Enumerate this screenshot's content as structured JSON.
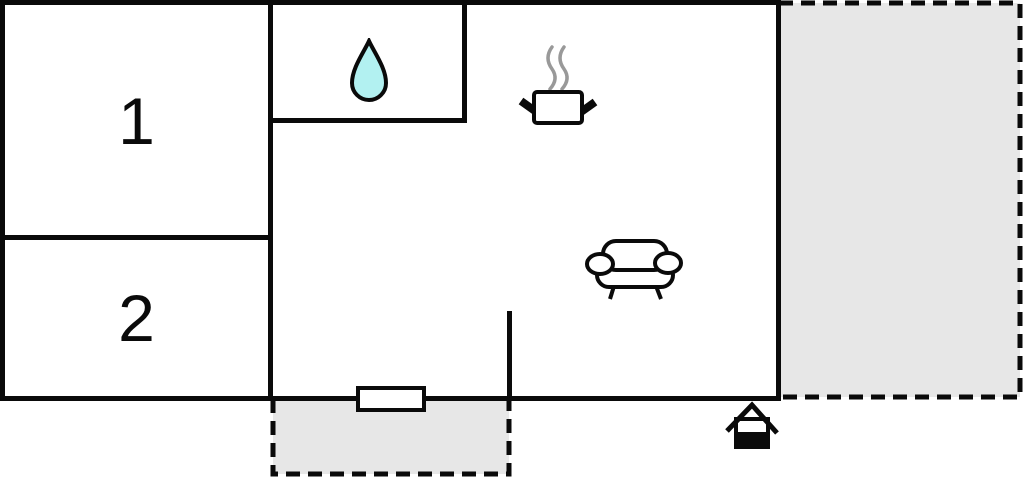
{
  "floorplan": {
    "rooms": [
      {
        "label": "1"
      },
      {
        "label": "2"
      }
    ],
    "icons": {
      "bathroom": "water-drop-icon",
      "kitchen": "cooking-pot-steam-icon",
      "living_area": "sofa-icon",
      "entrance": "house-entrance-icon"
    },
    "areas": {
      "terrace_right": "terrace-right",
      "terrace_bottom": "terrace-bottom"
    },
    "colors": {
      "wall": "#0a0a0a",
      "terrace_fill": "#e7e7e7",
      "water_drop_fill": "#b2f1f1",
      "steam": "#999999",
      "background": "#ffffff"
    }
  }
}
